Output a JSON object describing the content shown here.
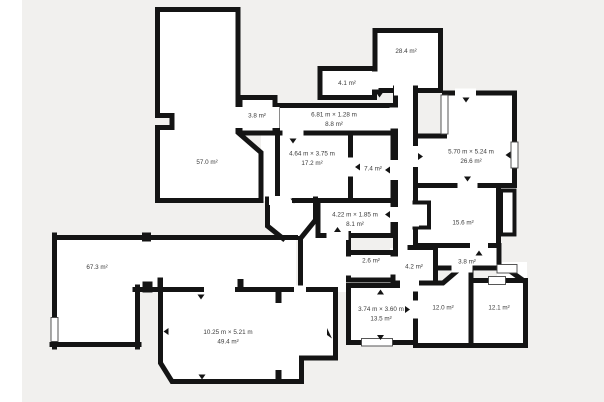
{
  "canvas": {
    "floor_background": "#f1f0ee",
    "page_background": "#ffffff",
    "wall_color": "#141414",
    "room_fill": "#ffffff",
    "label_color": "#3a3a3a"
  },
  "rooms": [
    {
      "id": "room-57-0",
      "area": "57.0 m²"
    },
    {
      "id": "room-3-8-top",
      "area": "3.8 m²"
    },
    {
      "id": "room-4-1",
      "area": "4.1 m²"
    },
    {
      "id": "room-28-4",
      "area": "28.4 m²"
    },
    {
      "id": "corridor-8-8",
      "dimensions": "6.81 m × 1.28 m",
      "area": "8.8 m²"
    },
    {
      "id": "room-17-2",
      "dimensions": "4.64 m × 3.75 m",
      "area": "17.2 m²"
    },
    {
      "id": "room-7-4",
      "area": "7.4 m²"
    },
    {
      "id": "room-26-6",
      "dimensions": "5.70 m × 5.24 m",
      "area": "26.6 m²"
    },
    {
      "id": "room-8-1",
      "dimensions": "4.22 m × 1.85 m",
      "area": "8.1 m²"
    },
    {
      "id": "room-15-6",
      "area": "15.6 m²"
    },
    {
      "id": "room-67-3",
      "area": "67.3 m²"
    },
    {
      "id": "room-2-6",
      "area": "2.6 m²"
    },
    {
      "id": "room-4-2",
      "area": "4.2 m²"
    },
    {
      "id": "room-3-8-right",
      "area": "3.8 m²"
    },
    {
      "id": "room-13-5",
      "dimensions": "3.74 m × 3.60 m",
      "area": "13.5 m²"
    },
    {
      "id": "room-12-0",
      "area": "12.0 m²"
    },
    {
      "id": "room-12-1",
      "area": "12.1 m²"
    },
    {
      "id": "room-49-4",
      "dimensions": "10.25 m × 5.21 m",
      "area": "49.4 m²"
    }
  ]
}
